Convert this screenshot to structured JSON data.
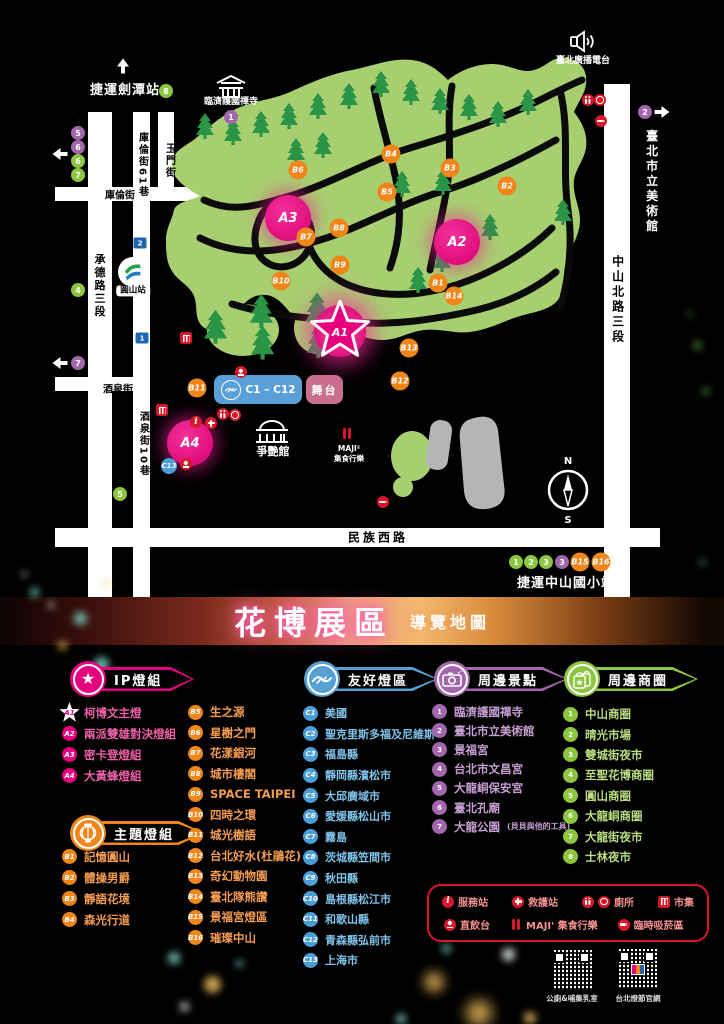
{
  "title": {
    "main": "花博展區",
    "sub": "導覽地圖"
  },
  "colors": {
    "pink": "#e6007e",
    "orange": "#f08519",
    "blue": "#4a9fd8",
    "purple": "#a266aa",
    "green": "#8cc63f",
    "red": "#d7182a",
    "park": "#a7cf70"
  },
  "map": {
    "czone_label": "C1 – C12",
    "stage_label": "舞台",
    "mrt_station": "圓山站",
    "compass": {
      "n": "N",
      "s": "S"
    },
    "a1": {
      "id": "A1",
      "x": 340,
      "y": 331
    },
    "a_markers": [
      {
        "id": "A2",
        "x": 457,
        "y": 242
      },
      {
        "id": "A3",
        "x": 288,
        "y": 218
      },
      {
        "id": "A4",
        "x": 190,
        "y": 443
      }
    ],
    "b_markers": [
      {
        "id": "B1",
        "x": 438,
        "y": 283
      },
      {
        "id": "B2",
        "x": 507,
        "y": 186
      },
      {
        "id": "B3",
        "x": 450,
        "y": 168
      },
      {
        "id": "B4",
        "x": 391,
        "y": 154
      },
      {
        "id": "B5",
        "x": 387,
        "y": 192
      },
      {
        "id": "B6",
        "x": 298,
        "y": 170
      },
      {
        "id": "B7",
        "x": 306,
        "y": 237
      },
      {
        "id": "B8",
        "x": 339,
        "y": 228
      },
      {
        "id": "B9",
        "x": 340,
        "y": 265
      },
      {
        "id": "B10",
        "x": 281,
        "y": 281
      },
      {
        "id": "B11",
        "x": 197,
        "y": 388
      },
      {
        "id": "B12",
        "x": 400,
        "y": 381
      },
      {
        "id": "B13",
        "x": 409,
        "y": 348
      },
      {
        "id": "B14",
        "x": 454,
        "y": 296
      },
      {
        "id": "B15",
        "x": 580,
        "y": 562
      },
      {
        "id": "B16",
        "x": 601,
        "y": 562
      }
    ],
    "purple_markers": [
      {
        "label": "1",
        "x": 231,
        "y": 117
      },
      {
        "label": "2",
        "x": 645,
        "y": 112
      },
      {
        "label": "3",
        "x": 562,
        "y": 562
      },
      {
        "label": "5",
        "x": 78,
        "y": 133
      },
      {
        "label": "6",
        "x": 78,
        "y": 147
      },
      {
        "label": "7",
        "x": 78,
        "y": 363
      }
    ],
    "green_markers": [
      {
        "label": "8",
        "x": 166,
        "y": 91
      },
      {
        "label": "6",
        "x": 78,
        "y": 161
      },
      {
        "label": "7",
        "x": 78,
        "y": 175
      },
      {
        "label": "4",
        "x": 78,
        "y": 290
      },
      {
        "label": "5",
        "x": 120,
        "y": 494
      },
      {
        "label": "1",
        "x": 516,
        "y": 562
      },
      {
        "label": "2",
        "x": 531,
        "y": 562
      },
      {
        "label": "3",
        "x": 546,
        "y": 562
      }
    ],
    "c_markers": [
      {
        "id": "C13",
        "x": 169,
        "y": 466
      }
    ],
    "exits": [
      {
        "label": "2",
        "x": 140,
        "y": 243
      },
      {
        "label": "1",
        "x": 142,
        "y": 338
      }
    ],
    "arrows": [
      {
        "dir": "up",
        "x": 123,
        "y": 66
      },
      {
        "dir": "left",
        "x": 60,
        "y": 154
      },
      {
        "dir": "left",
        "x": 60,
        "y": 363
      },
      {
        "dir": "right",
        "x": 662,
        "y": 112
      },
      {
        "dir": "dr",
        "x": 614,
        "y": 591
      }
    ],
    "facility_icons": [
      {
        "t": "market",
        "x": 186,
        "y": 338
      },
      {
        "t": "water",
        "x": 241,
        "y": 372
      },
      {
        "t": "market",
        "x": 162,
        "y": 410
      },
      {
        "t": "info",
        "x": 196,
        "y": 422
      },
      {
        "t": "aid",
        "x": 211,
        "y": 423
      },
      {
        "t": "toilet",
        "x": 223,
        "y": 414
      },
      {
        "t": "access",
        "x": 235,
        "y": 415
      },
      {
        "t": "water",
        "x": 186,
        "y": 464
      },
      {
        "t": "toilet",
        "x": 588,
        "y": 100
      },
      {
        "t": "access",
        "x": 600,
        "y": 100
      },
      {
        "t": "smoke",
        "x": 601,
        "y": 121
      },
      {
        "t": "smoke",
        "x": 383,
        "y": 502
      },
      {
        "t": "maji",
        "x": 347,
        "y": 433
      }
    ],
    "labels": [
      {
        "text": "捷運劍潭站",
        "x": 125,
        "y": 91,
        "cls": "wt st"
      },
      {
        "text": "玉門街",
        "x": 169,
        "y": 161,
        "cls": "v rd"
      },
      {
        "text": "庫倫街61巷",
        "x": 142,
        "y": 165,
        "cls": "v rd"
      },
      {
        "text": "庫倫街",
        "x": 120,
        "y": 196,
        "cls": "rd"
      },
      {
        "text": "承德路三段",
        "x": 99,
        "y": 286,
        "cls": "v rd md"
      },
      {
        "text": "酒泉街",
        "x": 118,
        "y": 390,
        "cls": "rd"
      },
      {
        "text": "酒泉街10巷",
        "x": 143,
        "y": 444,
        "cls": "v rd"
      },
      {
        "text": "民族西路",
        "x": 378,
        "y": 538,
        "cls": "rd lg"
      },
      {
        "text": "中山北路三段",
        "x": 617,
        "y": 300,
        "cls": "v rd lg"
      },
      {
        "text": "臺北市立美術館",
        "x": 651,
        "y": 182,
        "cls": "v wt lg"
      },
      {
        "text": "臺北廣播電台",
        "x": 583,
        "y": 62,
        "cls": "wt sm"
      },
      {
        "text": "臨濟護國禪寺",
        "x": 231,
        "y": 103,
        "cls": "wt sm"
      },
      {
        "text": "爭艷館",
        "x": 273,
        "y": 452,
        "cls": "wt md"
      },
      {
        "text": "MAJI²",
        "x": 349,
        "y": 449,
        "cls": "wt xs"
      },
      {
        "text": "集食行樂",
        "x": 349,
        "y": 459,
        "cls": "wt xs"
      },
      {
        "text": "捷運中山國小站",
        "x": 566,
        "y": 584,
        "cls": "wt st"
      },
      {
        "text": "圓山站",
        "x": 133,
        "y": 291,
        "cls": "mrt"
      }
    ]
  },
  "legend": {
    "ip": {
      "title": "IP燈組",
      "items": [
        {
          "id": "A1",
          "label": "柯博文主燈",
          "cls": "star"
        },
        {
          "id": "A2",
          "label": "兩派雙雄對決燈組"
        },
        {
          "id": "A3",
          "label": "密卡登燈組"
        },
        {
          "id": "A4",
          "label": "大黃蜂燈組"
        }
      ]
    },
    "theme": {
      "title": "主題燈組",
      "items_left": [
        {
          "id": "B1",
          "label": "記憶圓山"
        },
        {
          "id": "B2",
          "label": "體操男爵"
        },
        {
          "id": "B3",
          "label": "靜語花境"
        },
        {
          "id": "B4",
          "label": "森光行道"
        }
      ],
      "items_right": [
        {
          "id": "B5",
          "label": "生之源"
        },
        {
          "id": "B6",
          "label": "星樹之門"
        },
        {
          "id": "B7",
          "label": "花漾銀河"
        },
        {
          "id": "B8",
          "label": "城市樓閣"
        },
        {
          "id": "B9",
          "label": "SPACE TAIPEI"
        },
        {
          "id": "B10",
          "label": "四時之環"
        },
        {
          "id": "B11",
          "label": "城光樹語"
        },
        {
          "id": "B12",
          "label": "台北好水(杜鵑花)"
        },
        {
          "id": "B13",
          "label": "奇幻動物園"
        },
        {
          "id": "B14",
          "label": "臺北隊熊讚"
        },
        {
          "id": "B15",
          "label": "景福宮燈區"
        },
        {
          "id": "B16",
          "label": "璀璨中山"
        }
      ]
    },
    "friendly": {
      "title": "友好燈區",
      "items": [
        {
          "id": "C1",
          "label": "美國"
        },
        {
          "id": "C2",
          "label": "聖克里斯多福及尼維斯"
        },
        {
          "id": "C3",
          "label": "福島縣"
        },
        {
          "id": "C4",
          "label": "靜岡縣濱松市"
        },
        {
          "id": "C5",
          "label": "大邱廣域市"
        },
        {
          "id": "C6",
          "label": "愛媛縣松山市"
        },
        {
          "id": "C7",
          "label": "霧島"
        },
        {
          "id": "C8",
          "label": "茨城縣笠間市"
        },
        {
          "id": "C9",
          "label": "秋田縣"
        },
        {
          "id": "C10",
          "label": "島根縣松江市"
        },
        {
          "id": "C11",
          "label": "和歌山縣"
        },
        {
          "id": "C12",
          "label": "青森縣弘前市"
        },
        {
          "id": "C13",
          "label": "上海市"
        }
      ]
    },
    "sights": {
      "title": "周邊景點",
      "items": [
        {
          "id": "1",
          "label": "臨濟護國禪寺"
        },
        {
          "id": "2",
          "label": "臺北市立美術館"
        },
        {
          "id": "3",
          "label": "景福宮"
        },
        {
          "id": "4",
          "label": "台北市文昌宮"
        },
        {
          "id": "5",
          "label": "大龍峒保安宮"
        },
        {
          "id": "6",
          "label": "臺北孔廟"
        },
        {
          "id": "7",
          "label": "大龍公園",
          "note": "(貝貝與他的工具)"
        }
      ]
    },
    "shops": {
      "title": "周邊商圈",
      "items": [
        {
          "id": "1",
          "label": "中山商圈"
        },
        {
          "id": "2",
          "label": "晴光市場"
        },
        {
          "id": "3",
          "label": "雙城街夜市"
        },
        {
          "id": "4",
          "label": "至聖花博商圈"
        },
        {
          "id": "5",
          "label": "圓山商圈"
        },
        {
          "id": "6",
          "label": "大龍峒商圈"
        },
        {
          "id": "7",
          "label": "大龍街夜市"
        },
        {
          "id": "8",
          "label": "士林夜市"
        }
      ]
    }
  },
  "facility_box": {
    "row1": [
      {
        "icon": "info",
        "label": "服務站"
      },
      {
        "icon": "aid",
        "label": "救護站"
      },
      {
        "icon": "toilet",
        "icon2": "access",
        "label": "廁所"
      },
      {
        "icon": "market",
        "label": "市集"
      }
    ],
    "row2": [
      {
        "icon": "water",
        "label": "直飲台"
      },
      {
        "icon": "maji",
        "label": "MAJI' 集食行樂"
      },
      {
        "icon": "smoke",
        "label": "臨時吸菸區"
      }
    ]
  },
  "qr_codes": [
    {
      "label": "公廁&哺集乳室"
    },
    {
      "label": "台北燈節官網"
    }
  ]
}
